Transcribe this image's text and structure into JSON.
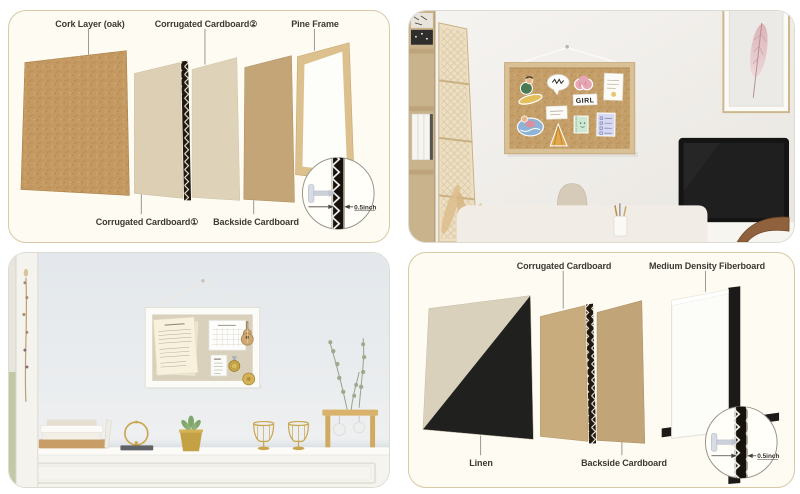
{
  "tl": {
    "cork": "Cork Layer (oak)",
    "corrugated2": "Corrugated Cardboard②",
    "pine": "Pine Frame",
    "corrugated1": "Corrugated Cardboard①",
    "backside": "Backside Cardboard",
    "thickness": "0.5inch"
  },
  "tr": {
    "girl_sticker": "GIRL"
  },
  "br": {
    "corrugated": "Corrugated Cardboard",
    "mdf": "Medium Density Fiberboard",
    "linen": "Linen",
    "backside": "Backside Cardboard",
    "thickness": "0.5inch"
  },
  "colors": {
    "cork": "#c49a62",
    "pine_frame": "#dcc18f",
    "cardboard_light": "#dccfb3",
    "cardboard_tan": "#c9ac7e",
    "backside_cardboard": "#c3a577",
    "linen": "#d9d1bc",
    "black_frame": "#1b1a18",
    "mdf_white": "#fcfcf9",
    "diagram_card_bg": "#fefbf3",
    "diagram_card_border": "#d9c8a5",
    "label_text": "#3b3a33"
  }
}
